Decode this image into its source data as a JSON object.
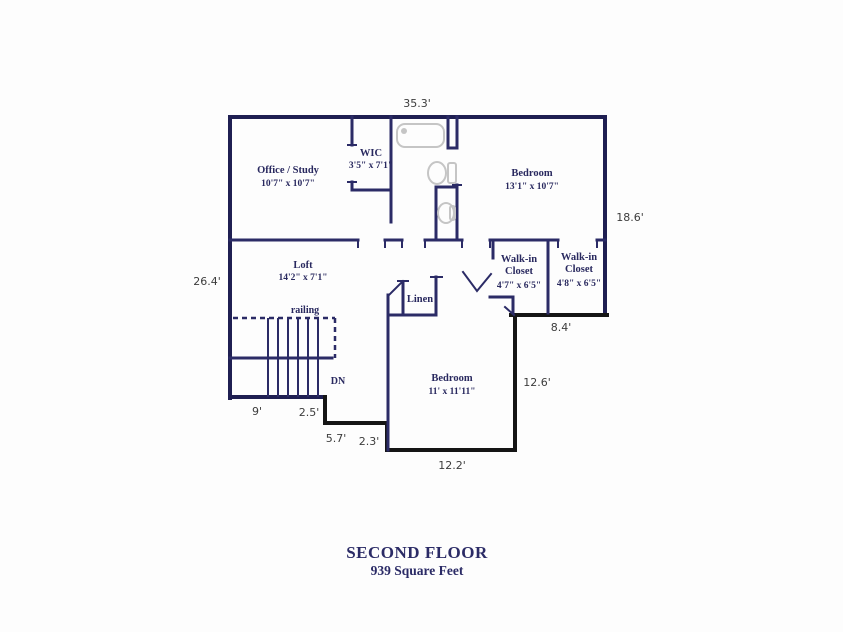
{
  "title": {
    "line1": "SECOND FLOOR",
    "line2": "939 Square Feet"
  },
  "colors": {
    "wall_navy": "#2b2b66",
    "wall_black": "#151515",
    "label_navy": "#29295f",
    "dimension_gray": "#3c3c3c",
    "fixture_gray": "#c5c5c5",
    "background": "#fdfdfd"
  },
  "rooms": {
    "office": {
      "label": "Office / Study",
      "dims": "10'7\" x 10'7\""
    },
    "wic": {
      "label": "WIC",
      "dims": "3'5\" x 7'1\""
    },
    "bedroom1": {
      "label": "Bedroom",
      "dims": "13'1\" x 10'7\""
    },
    "loft": {
      "label": "Loft",
      "dims": "14'2\" x 7'1\""
    },
    "closet_left": {
      "label": "Walk-in",
      "label2": "Closet",
      "dims": "4'7\" x 6'5\""
    },
    "closet_right": {
      "label": "Walk-in",
      "label2": "Closet",
      "dims": "4'8\" x 6'5\""
    },
    "linen": {
      "label": "Linen"
    },
    "bedroom2": {
      "label": "Bedroom",
      "dims": "11' x 11'11\""
    }
  },
  "annotations": {
    "railing": "railing",
    "down": "DN"
  },
  "dimensions": {
    "top": "35.3'",
    "right": "18.6'",
    "left": "26.4'",
    "step_right": "8.4'",
    "bedroom_right": "12.6'",
    "bedroom_bottom": "12.2'",
    "stair_run": "9'",
    "stair_step": "2.5'",
    "notch_bottom": "5.7'",
    "notch_side": "2.3'"
  }
}
